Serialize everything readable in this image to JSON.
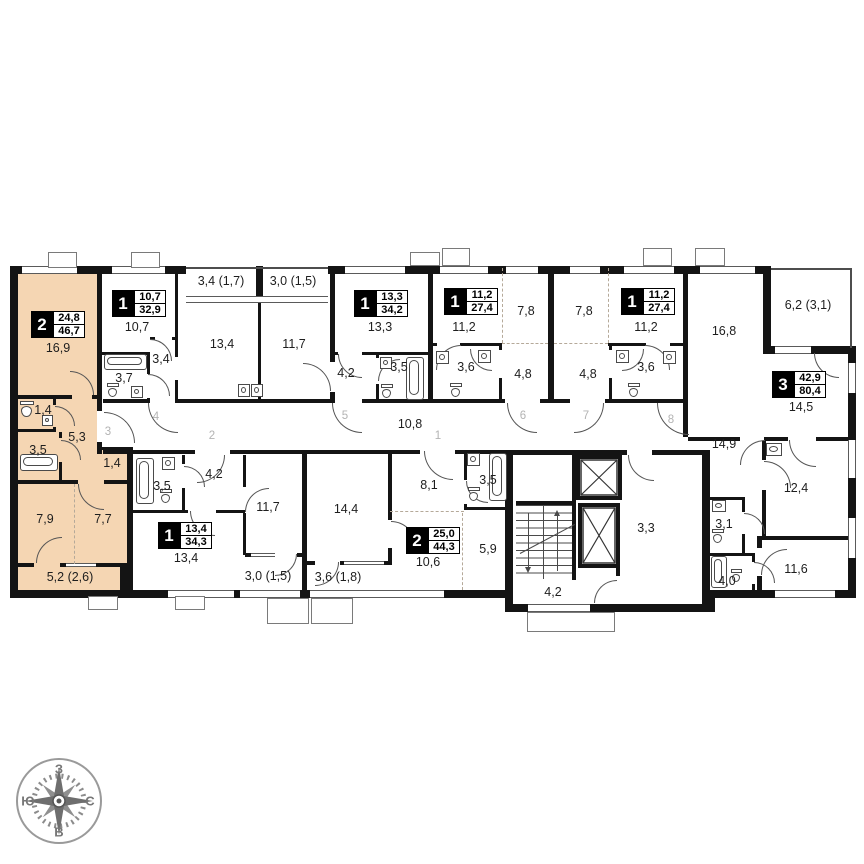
{
  "plan": {
    "room_labels": [
      "16,9",
      "10,7",
      "3,4 (1,7)",
      "3,0 (1,5)",
      "13,4",
      "11,7",
      "13,3",
      "11,2",
      "7,8",
      "7,8",
      "11,2",
      "16,8",
      "6,2 (3,1)",
      "3,4",
      "3,7",
      "4,2",
      "3,5",
      "3,6",
      "4,8",
      "4,8",
      "3,6",
      "14,5",
      "10,8",
      "14,9",
      "1,4",
      "5,3",
      "3,5",
      "1,4",
      "7,9",
      "7,7",
      "5,2 (2,6)",
      "3,5",
      "4,2",
      "11,7",
      "13,4",
      "3,0 (1,5)",
      "14,4",
      "8,1",
      "3,5",
      "10,6",
      "5,9",
      "3,6 (1,8)",
      "3,3",
      "4,2",
      "3,1",
      "4,0",
      "12,4",
      "11,6"
    ],
    "door_numbers": [
      "3",
      "4",
      "2",
      "5",
      "1",
      "6",
      "7",
      "8"
    ],
    "apartments": [
      {
        "rooms": "2",
        "living_area": "24,8",
        "total_area": "46,7",
        "highlighted": true
      },
      {
        "rooms": "1",
        "living_area": "10,7",
        "total_area": "32,9",
        "highlighted": false
      },
      {
        "rooms": "1",
        "living_area": "13,3",
        "total_area": "34,2",
        "highlighted": false
      },
      {
        "rooms": "1",
        "living_area": "11,2",
        "total_area": "27,4",
        "highlighted": false
      },
      {
        "rooms": "1",
        "living_area": "11,2",
        "total_area": "27,4",
        "highlighted": false
      },
      {
        "rooms": "3",
        "living_area": "42,9",
        "total_area": "80,4",
        "highlighted": false
      },
      {
        "rooms": "1",
        "living_area": "13,4",
        "total_area": "34,3",
        "highlighted": false
      },
      {
        "rooms": "2",
        "living_area": "25,0",
        "total_area": "44,3",
        "highlighted": false
      }
    ],
    "highlight_color": "#f5d6b3",
    "wall_color": "#141414"
  },
  "compass": {
    "top": "З",
    "right": "С",
    "bottom": "В",
    "left": "Ю"
  }
}
